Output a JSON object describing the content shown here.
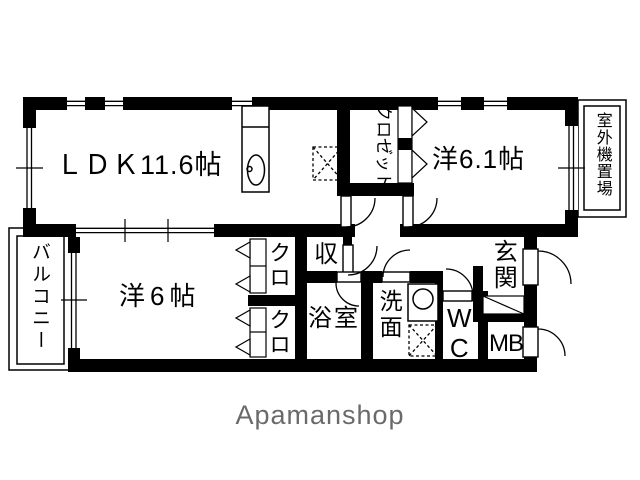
{
  "brand": {
    "logo_text": "Apamanshop",
    "color": "#6a6a6a"
  },
  "floor_plan": {
    "rooms": {
      "ldk": {
        "label": "ＬＤＫ11.6帖"
      },
      "western_room_1": {
        "label": "洋6.1帖"
      },
      "western_room_2": {
        "label": "洋6帖"
      },
      "balcony": {
        "label": "バルコニー"
      },
      "closet_main": {
        "label": "クロゼット"
      },
      "closet_upper": {
        "label": "クロ"
      },
      "closet_lower": {
        "label": "クロ"
      },
      "storage": {
        "label": "収"
      },
      "bathroom": {
        "label": "浴室"
      },
      "washroom": {
        "label": "洗面"
      },
      "toilet": {
        "label": "WC"
      },
      "entrance": {
        "label": "玄関"
      },
      "meter_box": {
        "label": "MB"
      },
      "outdoor_unit": {
        "label": "室外機置場"
      }
    },
    "colors": {
      "wall": "#000000",
      "background": "#ffffff"
    }
  }
}
